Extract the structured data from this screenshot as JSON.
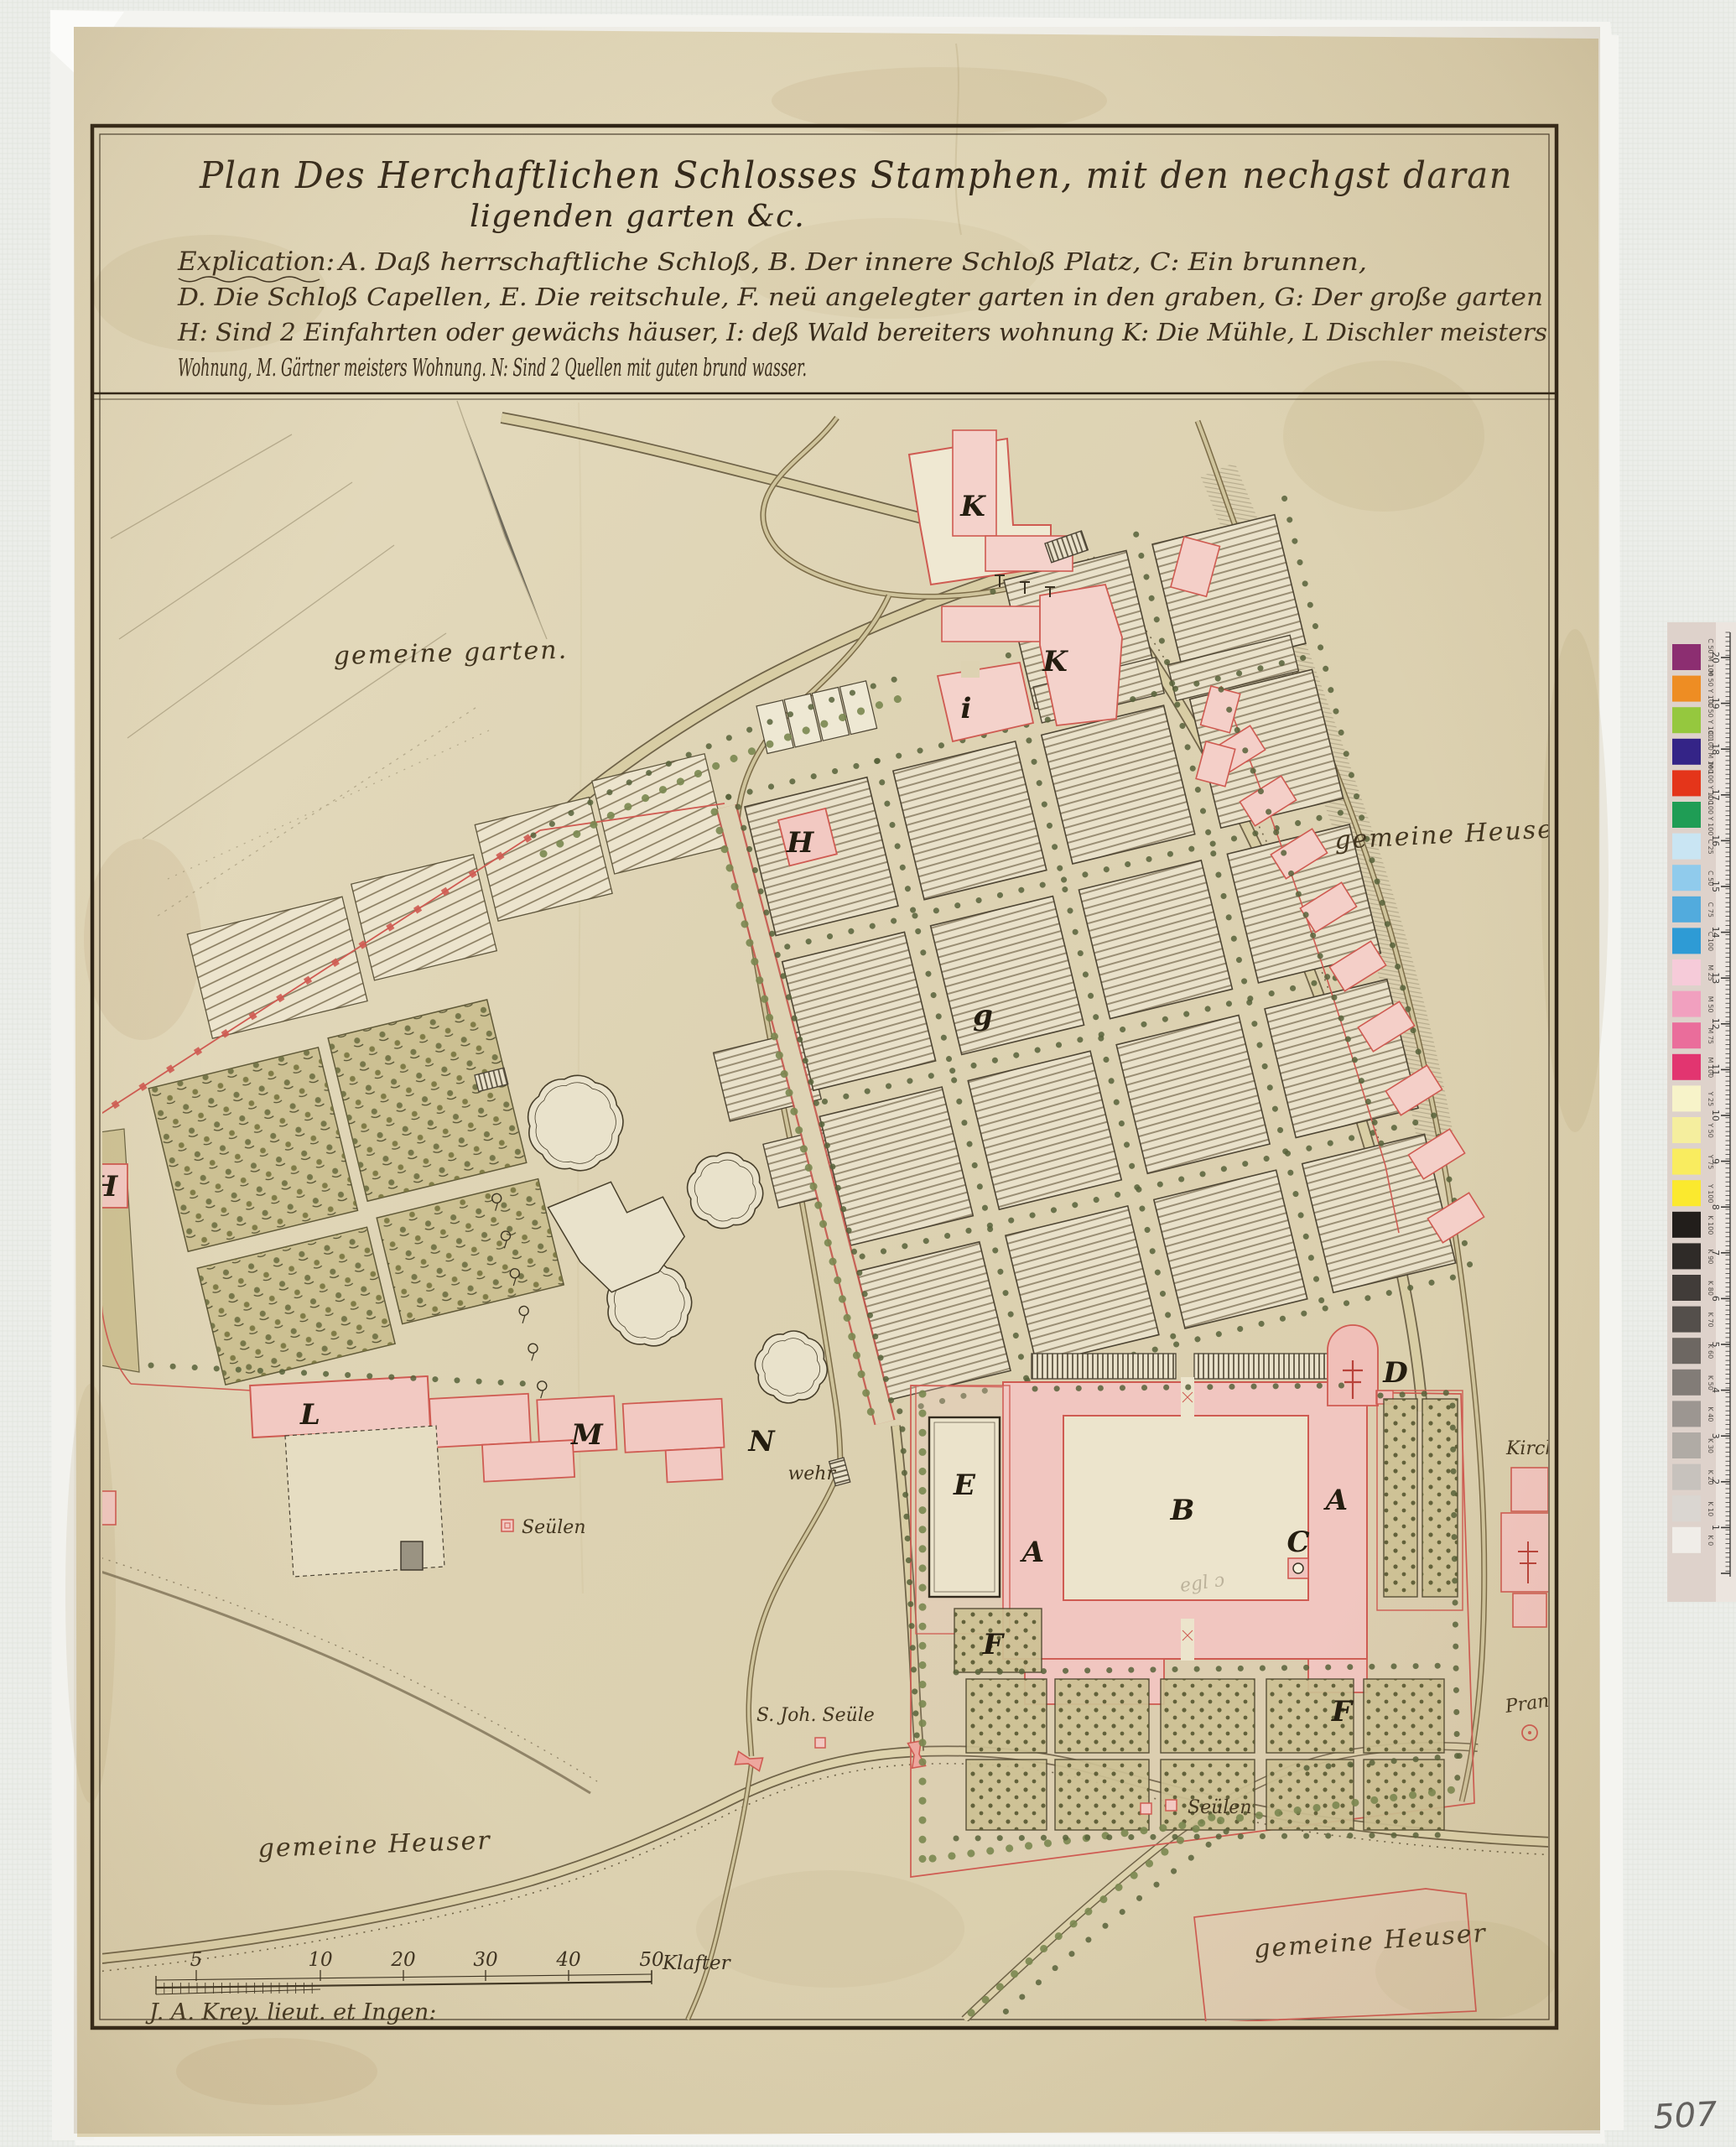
{
  "doc": {
    "title_line1": "Plan Des Herchaftlichen Schlosses Stamphen, mit den nechgst daran",
    "title_line2": "ligenden garten &c.",
    "explication_heading": "Explication:",
    "explication_lines": [
      "A. Daß herrschaftliche Schloß,   B. Der innere Schloß Platz,   C: Ein brunnen,",
      "D. Die Schloß Capellen,   E. Die reitschule,   F. neü angelegter garten in den graben,   G: Der große garten",
      "H: Sind 2 Einfahrten oder gewächs häuser,   I: deß Wald bereiters wohnung   K: Die Mühle,   L  Dischler meisters",
      "Wohnung,   M. Gärtner meisters Wohnung.   N: Sind 2 Quellen mit guten brund wasser."
    ],
    "signature": "J. A. Krey. lieut. et Ingen:",
    "inventory_number": "507"
  },
  "map": {
    "letters": {
      "k1": "K",
      "k2": "K",
      "i": "i",
      "h1": "H",
      "h2": "H",
      "g": "g",
      "l": "L",
      "m": "M",
      "n": "N",
      "e": "E",
      "b": "B",
      "a1": "A",
      "a2": "A",
      "c": "C",
      "d": "D",
      "f1": "F",
      "f2": "F"
    },
    "labels": {
      "gemeine_garten": "gemeine garten.",
      "gemeine_heuser_right": "gemeine Heuser",
      "gemeine_heuser_bottom_left": "gemeine Heuser",
      "gemeine_heuser_bottom_right": "gemeine Heuser",
      "wehr": "wehr",
      "seulen_left": "Seülen",
      "seulen_right": "Seülen",
      "joh_seule": "S. Joh. Seüle",
      "kirche": "Kirche",
      "pranger": "Pranger",
      "courtyard_note": "egl ɔ"
    },
    "scale_bar": {
      "tick_labels": [
        "5",
        "10",
        "20",
        "30",
        "40",
        "50"
      ],
      "unit": "Klafter"
    }
  },
  "color_bar": {
    "patches": [
      {
        "label": "C 50 M 100",
        "color": "#8c2e71"
      },
      {
        "label": "M 50 Y 100",
        "color": "#ee8d23"
      },
      {
        "label": "C 50 Y 100",
        "color": "#95c83e"
      },
      {
        "label": "C 100 M 100",
        "color": "#342487"
      },
      {
        "label": "M 100 Y 100",
        "color": "#e4351a"
      },
      {
        "label": "C 100 Y 100",
        "color": "#1f9d55"
      },
      {
        "label": "C 25",
        "color": "#c9e5f3"
      },
      {
        "label": "C 50",
        "color": "#90cbec"
      },
      {
        "label": "C 75",
        "color": "#52abdd"
      },
      {
        "label": "C 100",
        "color": "#2e9bd5"
      },
      {
        "label": "M 25",
        "color": "#f6cbd9"
      },
      {
        "label": "M 50",
        "color": "#f1a0bf"
      },
      {
        "label": "M 75",
        "color": "#ea6d9b"
      },
      {
        "label": "M 100",
        "color": "#e23570"
      },
      {
        "label": "Y 25",
        "color": "#f7f3c9"
      },
      {
        "label": "Y 50",
        "color": "#f5ee9e"
      },
      {
        "label": "Y 75",
        "color": "#f9ec5f"
      },
      {
        "label": "Y 100",
        "color": "#fbe92e"
      },
      {
        "label": "K 100",
        "color": "#221e1b"
      },
      {
        "label": "K 90",
        "color": "#2f2b28"
      },
      {
        "label": "K 80",
        "color": "#413c39"
      },
      {
        "label": "K 70",
        "color": "#544f4b"
      },
      {
        "label": "K 60",
        "color": "#6d6762"
      },
      {
        "label": "K 50",
        "color": "#827c77"
      },
      {
        "label": "K 40",
        "color": "#9c9691"
      },
      {
        "label": "K 30",
        "color": "#b0aba5"
      },
      {
        "label": "K 20",
        "color": "#c7c2bd"
      },
      {
        "label": "K 10",
        "color": "#dad6d1"
      },
      {
        "label": "K 0",
        "color": "#f0ede8"
      }
    ],
    "ruler_numbers": [
      20,
      19,
      18,
      17,
      16,
      15,
      14,
      13,
      12,
      11,
      10,
      9,
      8,
      7,
      6,
      5,
      4,
      3,
      2,
      1
    ]
  },
  "palette": {
    "paper": "#e0d6b8",
    "ink": "#33281a",
    "red_ink": "#cf5b52",
    "building_pink": "#f2c9c2",
    "garden_olive": "#cbbf90",
    "water_tan": "#cfc49c",
    "scan_bed": "#eceeea"
  }
}
